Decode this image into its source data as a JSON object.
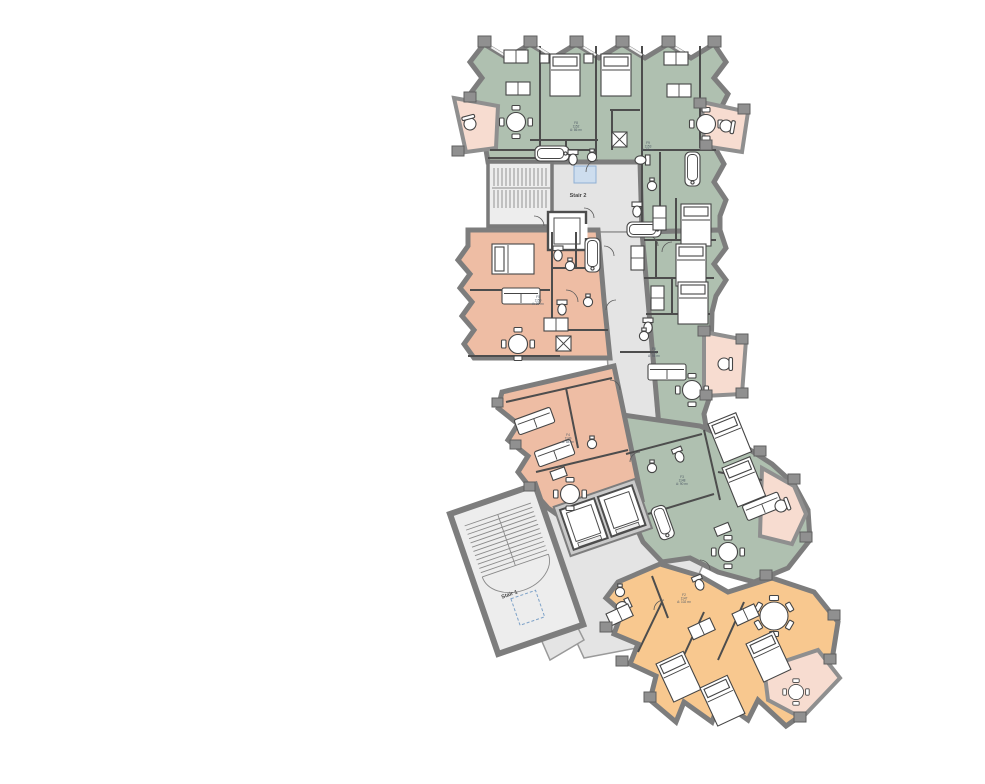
{
  "labels": {
    "stair1": "Stair 1",
    "stair2": "Stair 2"
  },
  "units": [
    {
      "name": "unit-label-1",
      "lines": [
        "F8",
        "1152",
        "A: 86 m²"
      ]
    },
    {
      "name": "unit-label-2",
      "lines": [
        "F9",
        "1153",
        "A: 92 m²"
      ]
    },
    {
      "name": "unit-label-3",
      "lines": [
        "F5",
        "1150",
        "A: 98 m²"
      ]
    },
    {
      "name": "unit-label-4",
      "lines": [
        "F6",
        "1151",
        "A: 95 m²"
      ]
    },
    {
      "name": "unit-label-5",
      "lines": [
        "F4",
        "1149",
        "A: 88 m²"
      ]
    },
    {
      "name": "unit-label-6",
      "lines": [
        "F3",
        "1148",
        "A: 90 m²"
      ]
    },
    {
      "name": "unit-label-7",
      "lines": [
        "F2",
        "1147",
        "A: 102 m²"
      ]
    }
  ],
  "colors": {
    "green": "#afc0b0",
    "salmon": "#eebda4",
    "orange": "#f8c88f",
    "balcony": "#f7dcd0",
    "corridor": "#e4e4e4",
    "stairFloor": "#ededed",
    "wall": "#7d7d7d",
    "blue": "#cdddee"
  }
}
